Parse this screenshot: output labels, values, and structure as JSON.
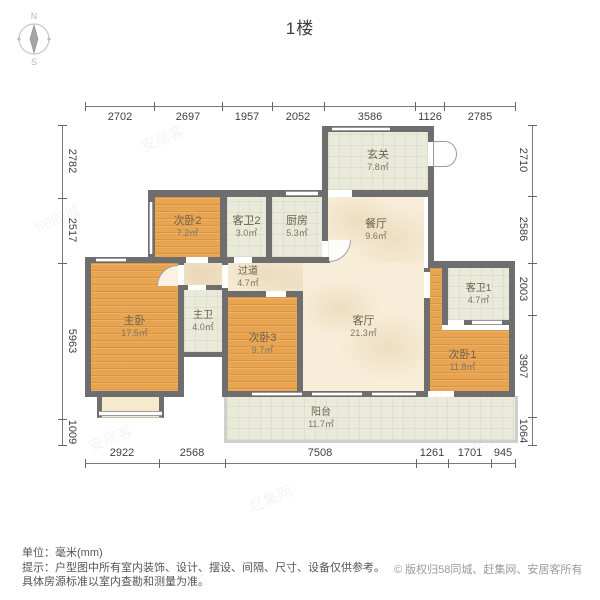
{
  "title": "1楼",
  "compass": {
    "north": "N",
    "south": "S"
  },
  "dims": {
    "top": [
      "2702",
      "2697",
      "1957",
      "2052",
      "3586",
      "1126",
      "2785"
    ],
    "bottom": [
      "2922",
      "2568",
      "7508",
      "1261",
      "1701",
      "945"
    ],
    "left": [
      "2782",
      "2517",
      "5963",
      "1009"
    ],
    "right": [
      "2710",
      "2586",
      "2003",
      "3907",
      "1064"
    ]
  },
  "rooms": {
    "xuanguan": {
      "name": "玄关",
      "area": "7.8㎡"
    },
    "chufang": {
      "name": "厨房",
      "area": "5.3㎡"
    },
    "kewei2": {
      "name": "客卫2",
      "area": "3.0㎡"
    },
    "ciwo2": {
      "name": "次卧2",
      "area": "7.2㎡"
    },
    "canting": {
      "name": "餐厅",
      "area": "9.6㎡"
    },
    "guodao": {
      "name": "过道",
      "area": "4.7㎡"
    },
    "zhuwo": {
      "name": "主卧",
      "area": "17.5㎡"
    },
    "zhuwei": {
      "name": "主卫",
      "area": "4.0㎡"
    },
    "ciwo3": {
      "name": "次卧3",
      "area": "9.7㎡"
    },
    "keting": {
      "name": "客厅",
      "area": "21.3㎡"
    },
    "kewei1": {
      "name": "客卫1",
      "area": "4.7㎡"
    },
    "ciwo1": {
      "name": "次卧1",
      "area": "11.8㎡"
    },
    "yangtai": {
      "name": "阳台",
      "area": "11.7㎡"
    }
  },
  "footer": {
    "unit_label": "单位：",
    "unit_value": "毫米(mm)",
    "tip_label": "提示：",
    "tip_line1": "户型图中所有室内装饰、设计、摆设、间隔、尺寸、设备仅供参考。",
    "tip_line2": "具体房源标准以室内查勘和测量为准。",
    "copyright": "© 版权归58同城、赶集网、安居客所有"
  },
  "watermarks": [
    "58同城",
    "安居客",
    "赶集网"
  ],
  "colors": {
    "wall": "#6E6E6E",
    "bedroom_floor": "#E9A451",
    "living_floor": "#F7EDD8",
    "tile_floor": "#EAEADA",
    "dim_text": "#3F3F3F"
  }
}
